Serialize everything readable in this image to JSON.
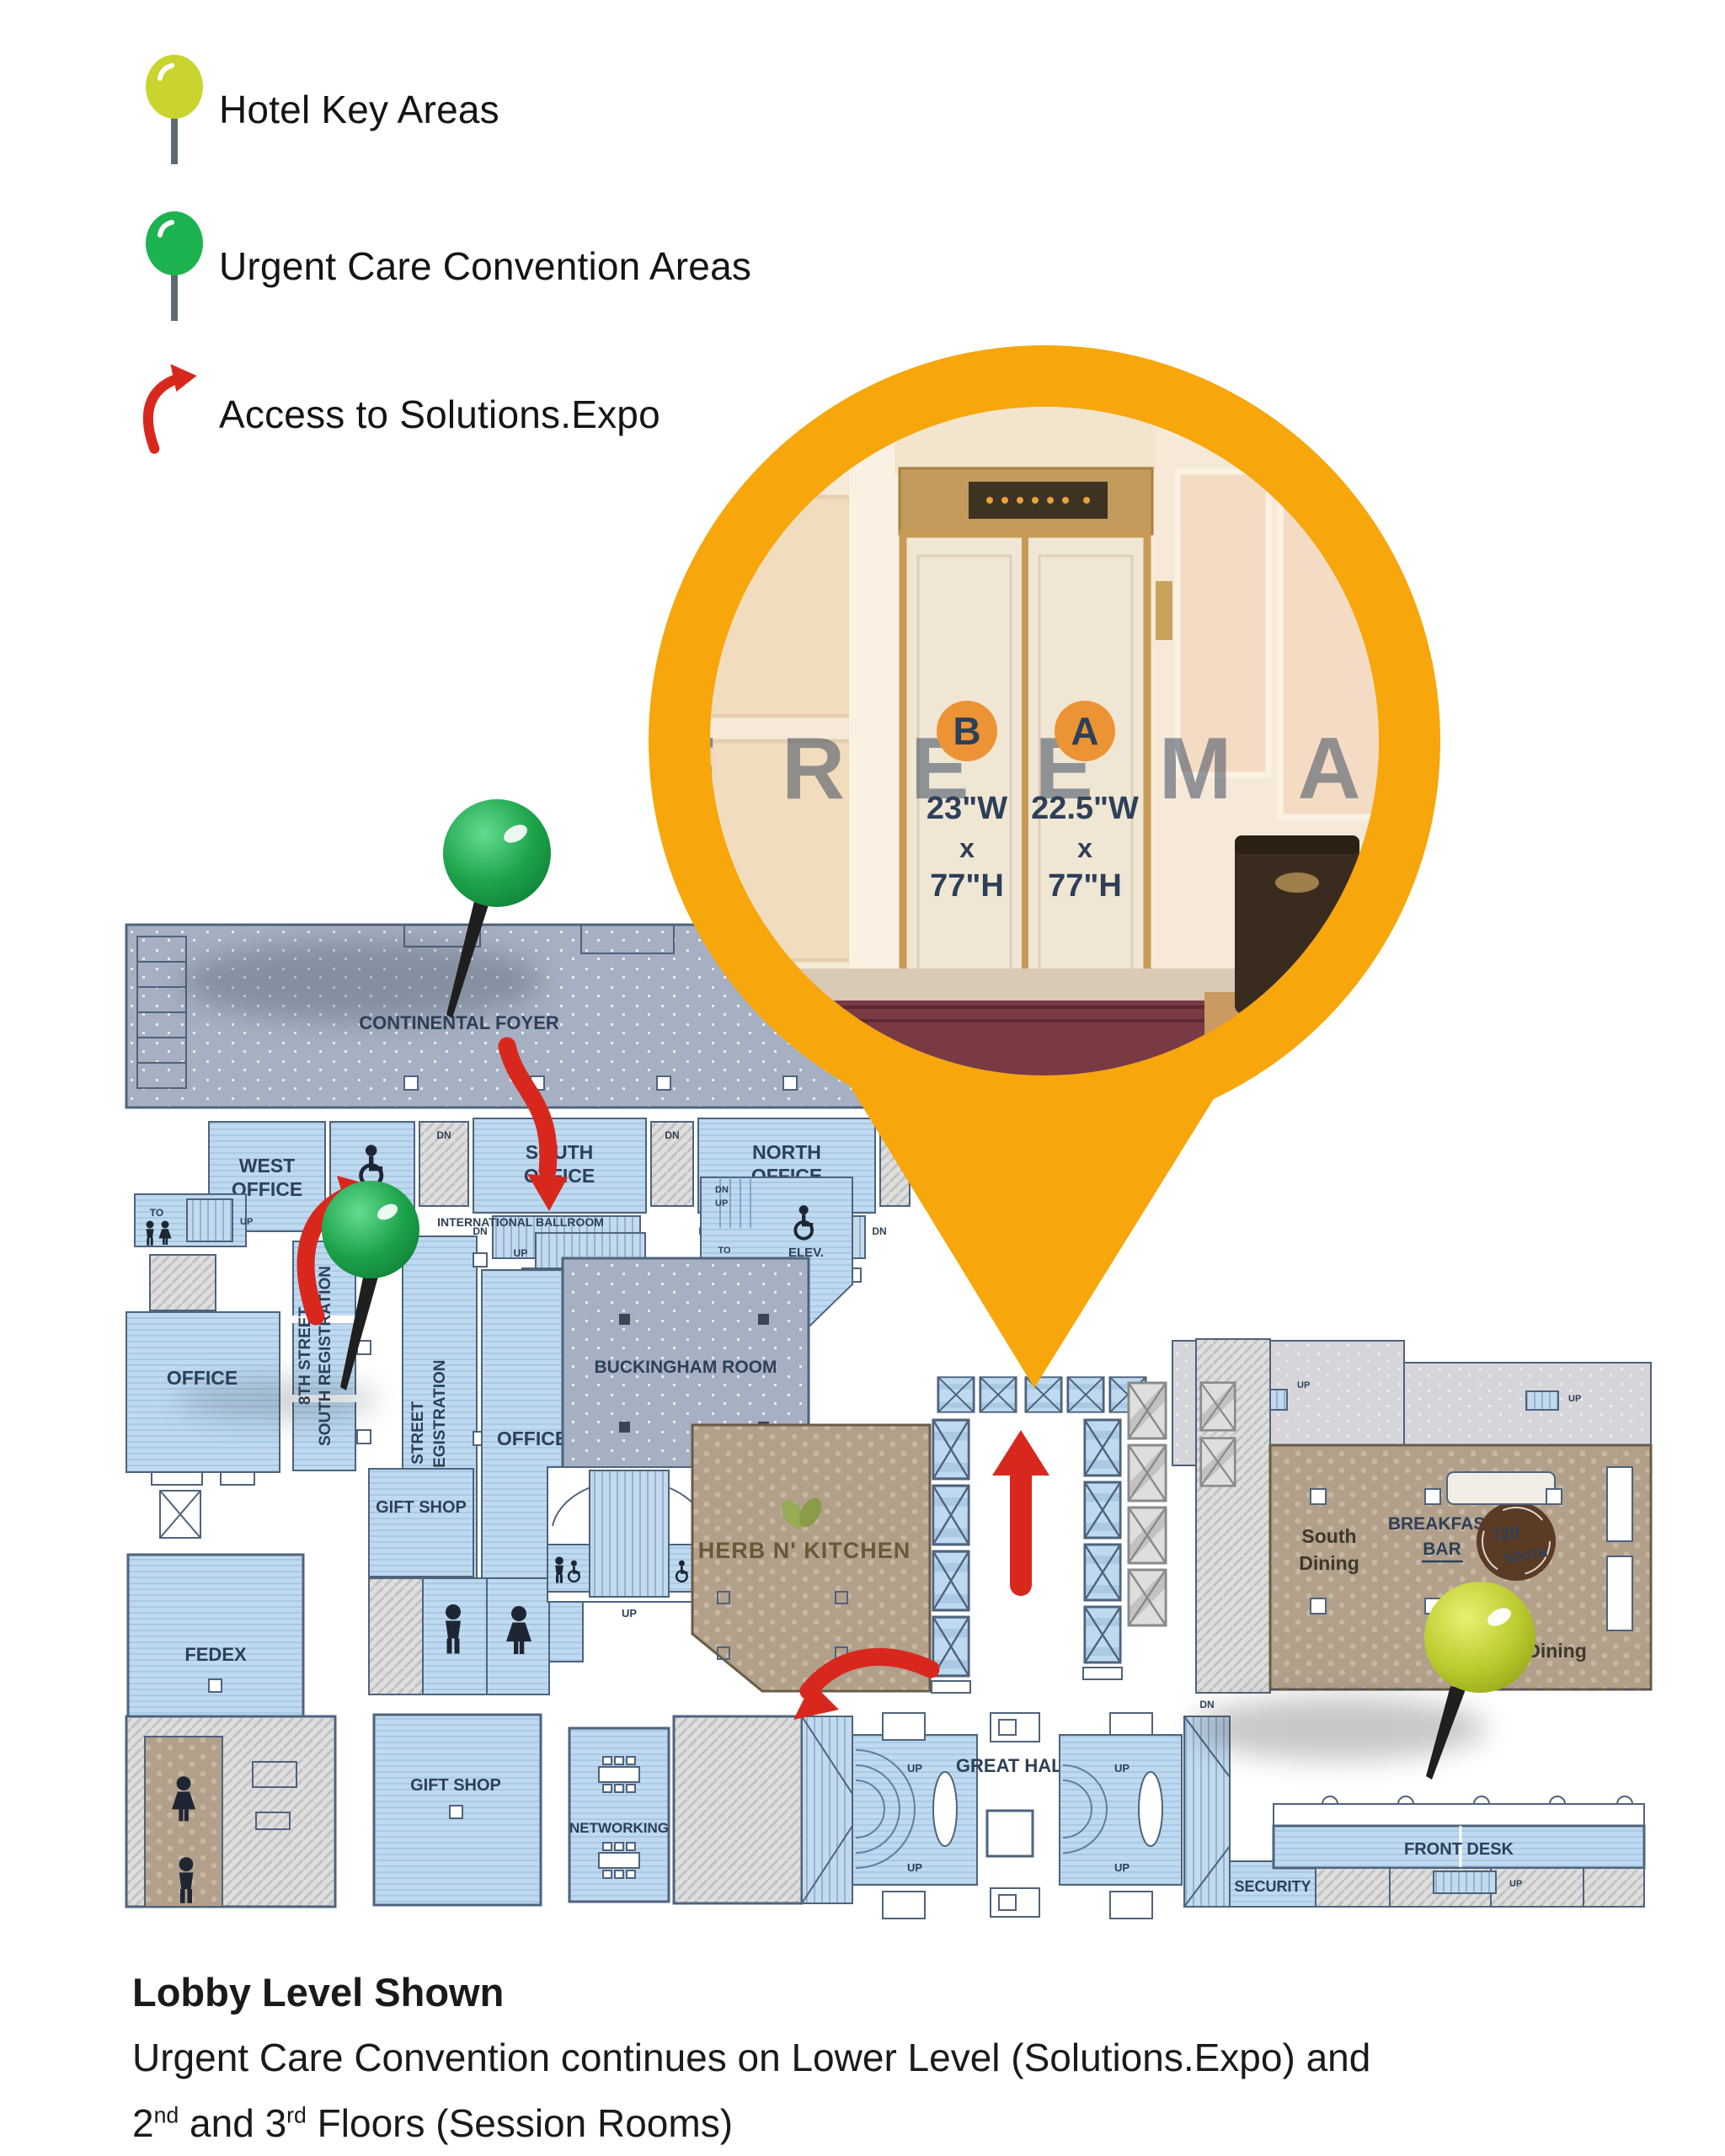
{
  "colors": {
    "accent_orange": "#F7A60B",
    "badge_orange": "#EC9335",
    "arrow_red": "#D8281E",
    "pin_green": "#1CA24A",
    "pin_yellow_green": "#BFCC2A",
    "room_blue": "#BFDAF0",
    "foyer_gray": "#A6B0C2",
    "corridor_brown": "#B2A08B",
    "label_navy": "#2E4058"
  },
  "legend": {
    "items": [
      {
        "icon": "yellow-green-pin-icon",
        "label": "Hotel Key Areas"
      },
      {
        "icon": "green-pin-icon",
        "label": "Urgent Care Convention Areas"
      },
      {
        "icon": "red-curved-arrow-icon",
        "label": "Access to Solutions.Expo"
      }
    ]
  },
  "callout": {
    "watermark": "FREEMA",
    "doors": [
      {
        "letter": "B",
        "width_label": "23\"W",
        "x_label": "x",
        "height_label": "77\"H"
      },
      {
        "letter": "A",
        "width_label": "22.5\"W",
        "x_label": "x",
        "height_label": "77\"H"
      }
    ]
  },
  "map": {
    "rooms": {
      "continental_foyer": "CONTINENTAL FOYER",
      "west_office_l1": "WEST",
      "west_office_l2": "OFFICE",
      "lift": "LIFT",
      "south_office_l1": "SOUTH",
      "south_office_l2": "OFFICE",
      "north_office_l1": "NORTH",
      "north_office_l2": "OFFICE",
      "international_ballroom": "INTERNATIONAL BALLROOM",
      "stairs_men_l1": "STAIRS TO",
      "stairs_men_l2": "MEN ONLY",
      "stairs_men_l3": "RESTROOM",
      "to_3rd_l1": "TO",
      "to_3rd_l2": "3RD",
      "to_3rd_l3": "FL.",
      "elev": "ELEV.",
      "office": "OFFICE",
      "south_reg_l1": "8TH STREET",
      "south_reg_l2": "SOUTH REGISTRATION",
      "north_reg_l1": "8TH STREET",
      "north_reg_l2": "NORTH REGISTRATION",
      "buckingham": "BUCKINGHAM ROOM",
      "gift_shop": "GIFT SHOP",
      "herb_n_kitchen": "HERB N' KITCHEN",
      "fedex": "FEDEX",
      "networking": "NETWORKING",
      "great_hall": "GREAT HALL",
      "front_desk": "FRONT DESK",
      "security": "SECURITY",
      "south_dining_l1": "South",
      "south_dining_l2": "Dining",
      "breakfast_bar_l1": "BREAKFAST",
      "breakfast_bar_l2": "BAR",
      "s720_l1": "720",
      "s720_l2": "SOUTH",
      "dining": "Dining"
    },
    "lbl": {
      "up": "UP",
      "dn": "DN",
      "to": "TO"
    }
  },
  "caption": {
    "title": "Lobby Level Shown",
    "line1": "Urgent Care Convention continues on Lower Level (Solutions.Expo) and",
    "line2_pre": "2",
    "line2_sup1": "nd",
    "line2_mid": " and 3",
    "line2_sup2": "rd",
    "line2_post": " Floors (Session Rooms)"
  }
}
